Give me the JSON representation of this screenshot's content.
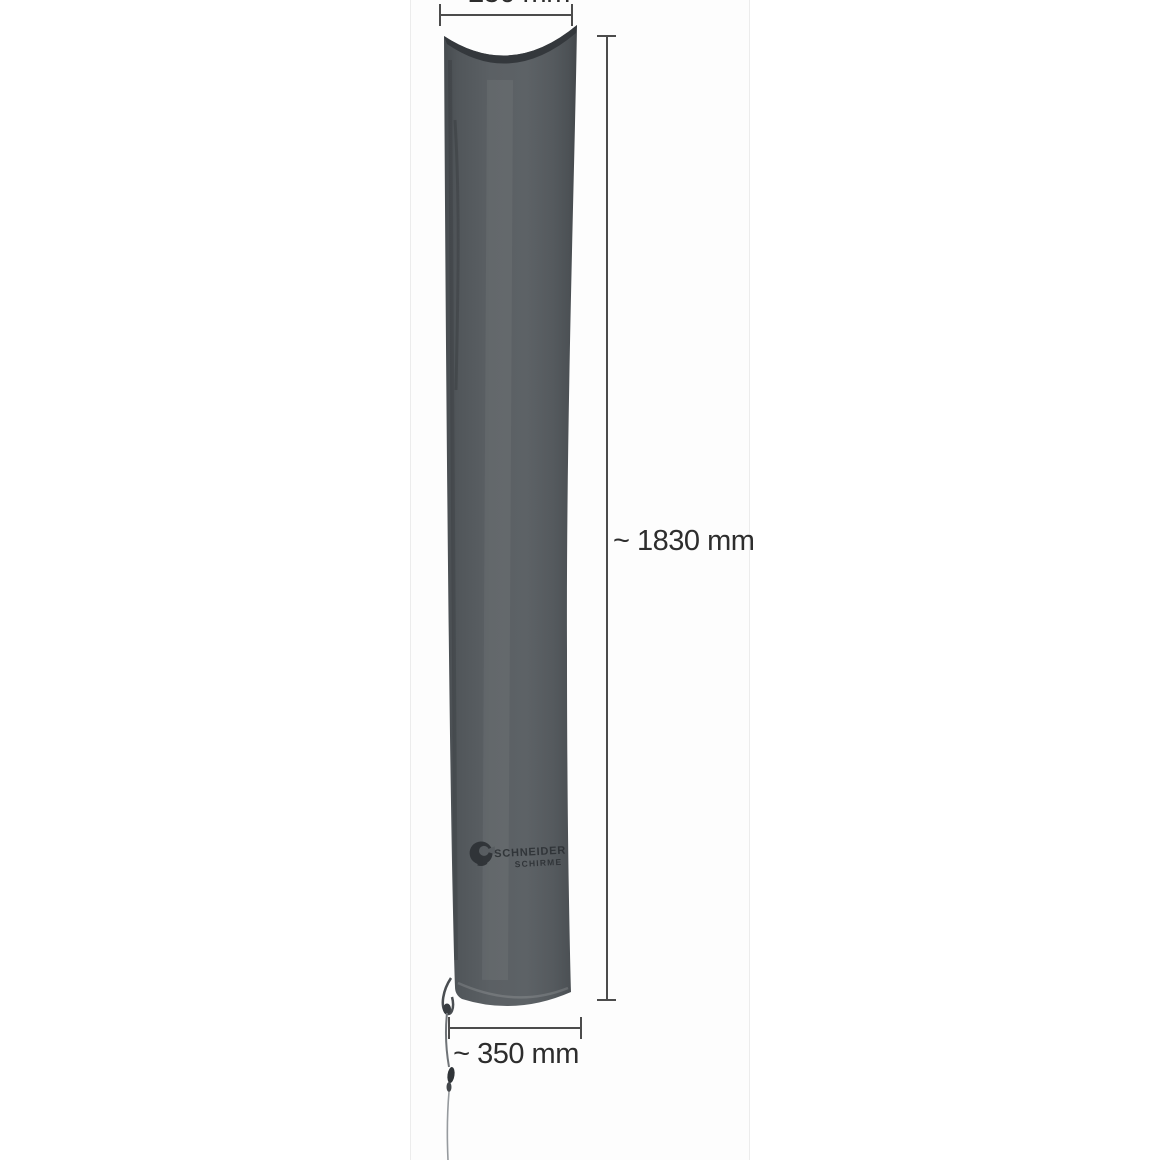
{
  "canvas": {
    "background": "#ffffff",
    "strip_background": "#fdfdfd",
    "strip_border": "#ececec"
  },
  "product": {
    "name": "umbrella protective cover",
    "logo": {
      "line1": "SCHNEIDER",
      "line2": "SCHIRME"
    },
    "colors": {
      "fabric_mid": "#5b6064",
      "fabric_shadow": "#474c50",
      "fabric_edge": "#43474b",
      "top_seam": "#34383c",
      "print": "#2b2f33",
      "cord_dark": "#4a4e52",
      "cord_light": "#969a9e",
      "knot": "#35393d"
    }
  },
  "dimensions": {
    "unit": "mm",
    "top_width": {
      "label": "~ 250 mm",
      "value": 250
    },
    "height": {
      "label": "~ 1830 mm",
      "value": 1830
    },
    "bottom_width": {
      "label": "~ 350 mm",
      "value": 350
    },
    "line_color": "#4c4c4c",
    "text_color": "#2d2d2d"
  }
}
